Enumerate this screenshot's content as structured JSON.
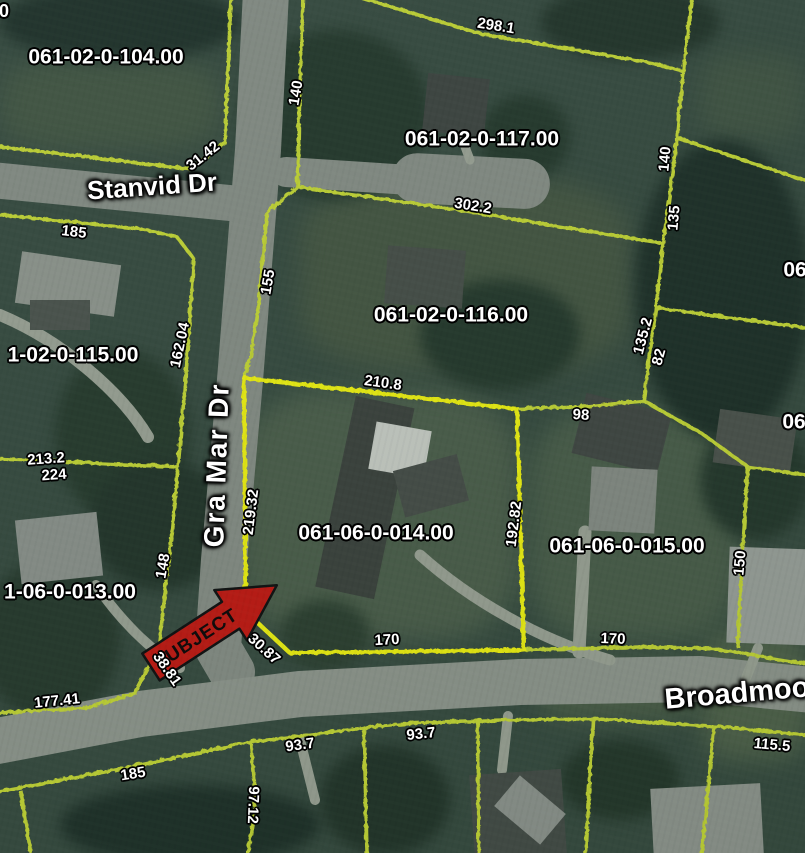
{
  "map": {
    "colors": {
      "parcel_line": "#c6d832",
      "subject_line": "#f2f40a",
      "arrow_fill": "#c3150e",
      "label_text": "#ffffff"
    },
    "subject_arrow": {
      "label": "SUBJECT"
    },
    "street_labels": [
      {
        "text": "Stanvid Dr",
        "x": 152,
        "y": 186,
        "rot": -4,
        "size": 26
      },
      {
        "text": "Gra Mar Dr",
        "x": 217,
        "y": 465,
        "rot": -88,
        "size": 28,
        "ls": 2
      },
      {
        "text": "Broadmoo",
        "x": 737,
        "y": 694,
        "rot": -5,
        "size": 29
      }
    ],
    "parcel_labels": [
      {
        "text": "061-02-0-104.00",
        "x": 106,
        "y": 57
      },
      {
        "text": "061-02-0-117.00",
        "x": 482,
        "y": 139
      },
      {
        "text": "061-02-0-116.00",
        "x": 451,
        "y": 315
      },
      {
        "text": "1-02-0-115.00",
        "x": 73,
        "y": 355
      },
      {
        "text": "061-06-0-014.00",
        "x": 376,
        "y": 533
      },
      {
        "text": "061-06-0-015.00",
        "x": 627,
        "y": 546
      },
      {
        "text": "1-06-0-013.00",
        "x": 70,
        "y": 592
      },
      {
        "text": "06",
        "x": 795,
        "y": 270
      },
      {
        "text": "06",
        "x": 794,
        "y": 422
      },
      {
        "text": "0",
        "x": 4,
        "y": 11,
        "size": 18
      }
    ],
    "dimension_labels": [
      {
        "text": "298.1",
        "x": 496,
        "y": 26,
        "rot": 9
      },
      {
        "text": "140",
        "x": 296,
        "y": 93,
        "rot": -80
      },
      {
        "text": "31.42",
        "x": 203,
        "y": 156,
        "rot": -38
      },
      {
        "text": "185",
        "x": 74,
        "y": 232,
        "rot": 7
      },
      {
        "text": "302.2",
        "x": 473,
        "y": 206,
        "rot": 9
      },
      {
        "text": "140",
        "x": 665,
        "y": 159,
        "rot": -85
      },
      {
        "text": "135",
        "x": 674,
        "y": 218,
        "rot": -85
      },
      {
        "text": "135.2",
        "x": 643,
        "y": 336,
        "rot": -75
      },
      {
        "text": "82",
        "x": 659,
        "y": 357,
        "rot": -75
      },
      {
        "text": "155",
        "x": 268,
        "y": 282,
        "rot": -80
      },
      {
        "text": "162.04",
        "x": 180,
        "y": 345,
        "rot": -78
      },
      {
        "text": "210.8",
        "x": 383,
        "y": 383,
        "rot": 8
      },
      {
        "text": "98",
        "x": 581,
        "y": 415,
        "rot": 3
      },
      {
        "text": "213.2",
        "x": 46,
        "y": 459,
        "rot": -4
      },
      {
        "text": "224",
        "x": 54,
        "y": 475,
        "rot": -4
      },
      {
        "text": "219.32",
        "x": 251,
        "y": 512,
        "rot": -83
      },
      {
        "text": "192.82",
        "x": 514,
        "y": 524,
        "rot": -83
      },
      {
        "text": "148",
        "x": 163,
        "y": 566,
        "rot": -80
      },
      {
        "text": "150",
        "x": 740,
        "y": 563,
        "rot": -85
      },
      {
        "text": "170",
        "x": 387,
        "y": 640,
        "rot": -3
      },
      {
        "text": "170",
        "x": 613,
        "y": 639,
        "rot": 2
      },
      {
        "text": "30.87",
        "x": 264,
        "y": 649,
        "rot": 42
      },
      {
        "text": "38.81",
        "x": 167,
        "y": 669,
        "rot": 55
      },
      {
        "text": "177.41",
        "x": 57,
        "y": 701,
        "rot": -6
      },
      {
        "text": "93.7",
        "x": 300,
        "y": 745,
        "rot": -8
      },
      {
        "text": "93.7",
        "x": 421,
        "y": 734,
        "rot": -6
      },
      {
        "text": "115.5",
        "x": 772,
        "y": 745,
        "rot": 5
      },
      {
        "text": "185",
        "x": 133,
        "y": 774,
        "rot": -9
      },
      {
        "text": "97.12",
        "x": 253,
        "y": 805,
        "rot": 92
      }
    ]
  }
}
